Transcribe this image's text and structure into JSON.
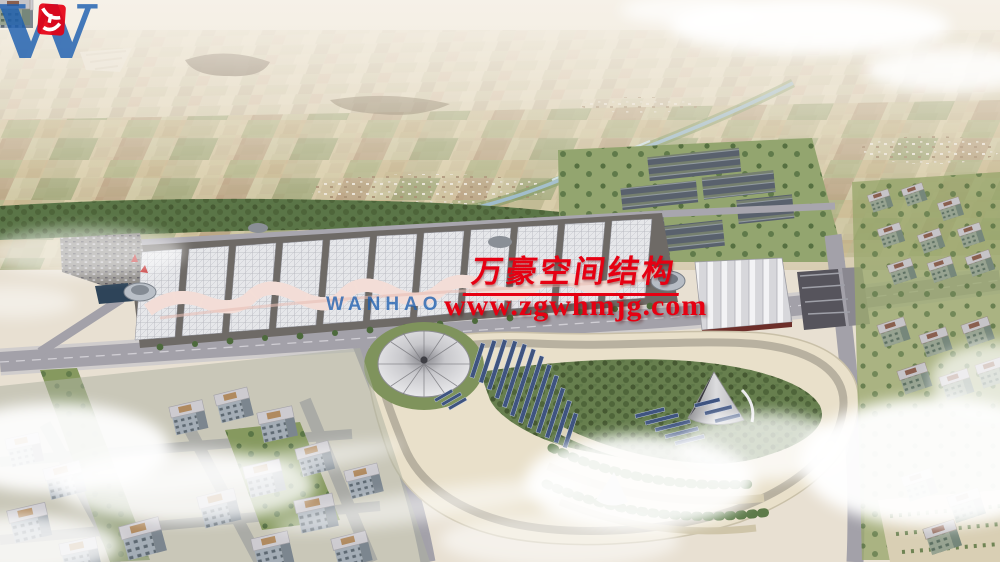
{
  "meta": {
    "kind": "aerial architectural rendering",
    "subject": "exhibition center complex with membrane-roof halls, landscaped park with dome tent and solar rows, greenhouse field, farmland horizon, surrounding city blocks and clouds"
  },
  "watermark": {
    "logo": {
      "letter": "W",
      "wordmark": "WANHAO"
    },
    "company_cn": "万豪空间结构",
    "website": "www.zgwhmjg.com"
  },
  "colors": {
    "wm-red": "#e60012",
    "wm-blue": "#1d5fb0",
    "haze": "#f1ece1",
    "hall-roof": "#e6e7ea",
    "canopy-pink": "#eccbc2",
    "park-sand": "#e9e0ca",
    "solar-navy": "#3f5480",
    "road-gray": "#a3a1a9",
    "tree-green": "#567245",
    "field-green": "#97a46c",
    "cloud-white": "#ffffff"
  }
}
